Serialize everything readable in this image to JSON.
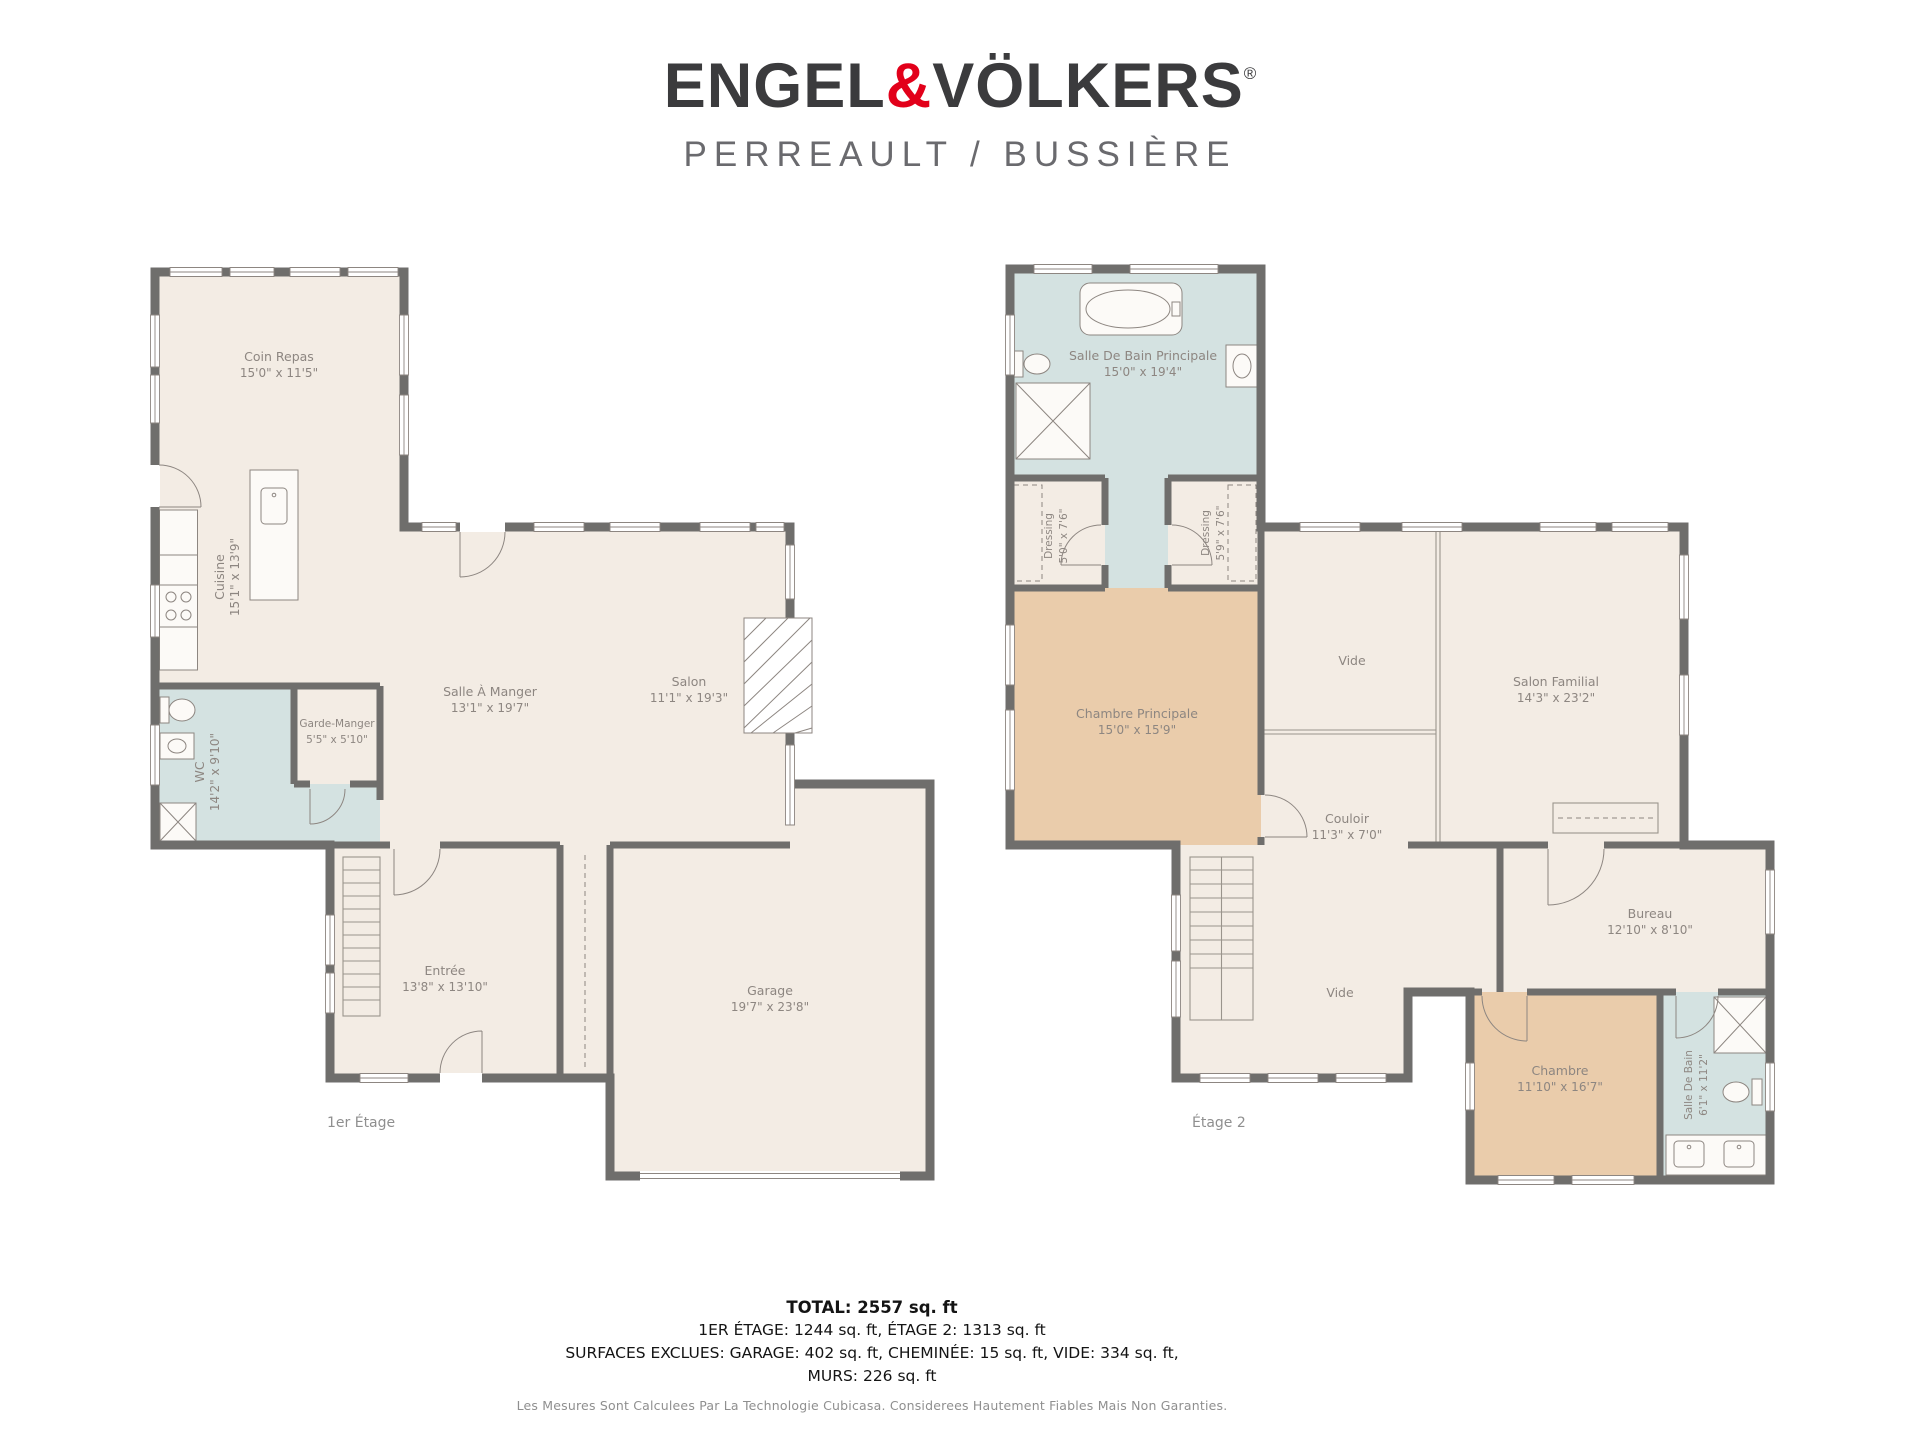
{
  "header": {
    "brand_part1": "ENGEL",
    "brand_amp": "&",
    "brand_part2": "VÖLKERS",
    "brand_reg": "®",
    "subtitle": "PERREAULT / BUSSIÈRE"
  },
  "floors": [
    {
      "label": "1er Étage",
      "rooms": [
        {
          "name": "Coin Repas",
          "dims": "15'0\" x 11'5\""
        },
        {
          "name": "Cuisine",
          "dims": "15'1\" x 13'9\""
        },
        {
          "name": "Salle À Manger",
          "dims": "13'1\" x 19'7\""
        },
        {
          "name": "Salon",
          "dims": "11'1\" x 19'3\""
        },
        {
          "name": "Garde-Manger",
          "dims": "5'5\" x 5'10\""
        },
        {
          "name": "WC",
          "dims": "14'2\" x 9'10\""
        },
        {
          "name": "Entrée",
          "dims": "13'8\" x 13'10\""
        },
        {
          "name": "Garage",
          "dims": "19'7\" x 23'8\""
        }
      ]
    },
    {
      "label": "Étage 2",
      "rooms": [
        {
          "name": "Salle De Bain Principale",
          "dims": "15'0\" x 19'4\""
        },
        {
          "name": "Dressing",
          "dims": "5'0\" x 7'6\""
        },
        {
          "name": "Dressing",
          "dims": "5'9\" x 7'6\""
        },
        {
          "name": "Chambre Principale",
          "dims": "15'0\" x 15'9\""
        },
        {
          "name": "Vide",
          "dims": ""
        },
        {
          "name": "Salon Familial",
          "dims": "14'3\" x 23'2\""
        },
        {
          "name": "Couloir",
          "dims": "11'3\" x 7'0\""
        },
        {
          "name": "Bureau",
          "dims": "12'10\" x 8'10\""
        },
        {
          "name": "Vide",
          "dims": ""
        },
        {
          "name": "Chambre",
          "dims": "11'10\" x 16'7\""
        },
        {
          "name": "Salle De Bain",
          "dims": "6'1\" x 11'2\""
        }
      ]
    }
  ],
  "summary": {
    "total": "TOTAL: 2557 sq. ft",
    "line2": "1ER ÉTAGE: 1244 sq. ft, ÉTAGE 2: 1313 sq. ft",
    "line3": "SURFACES EXCLUES: GARAGE: 402 sq. ft, CHEMINÉE: 15 sq. ft, VIDE: 334 sq. ft,",
    "line4": "MURS: 226 sq. ft"
  },
  "footer": {
    "disclaimer": "Les Mesures Sont Calculees Par La Technologie Cubicasa. Considerees Hautement Fiables Mais Non Garanties."
  },
  "colors": {
    "floor": "#f3ece4",
    "bathroom": "#d4e2e1",
    "bedroom": "#eaccab",
    "wall": "#6f6e6c",
    "label": "#8d8681",
    "accent_red": "#e2001a"
  }
}
